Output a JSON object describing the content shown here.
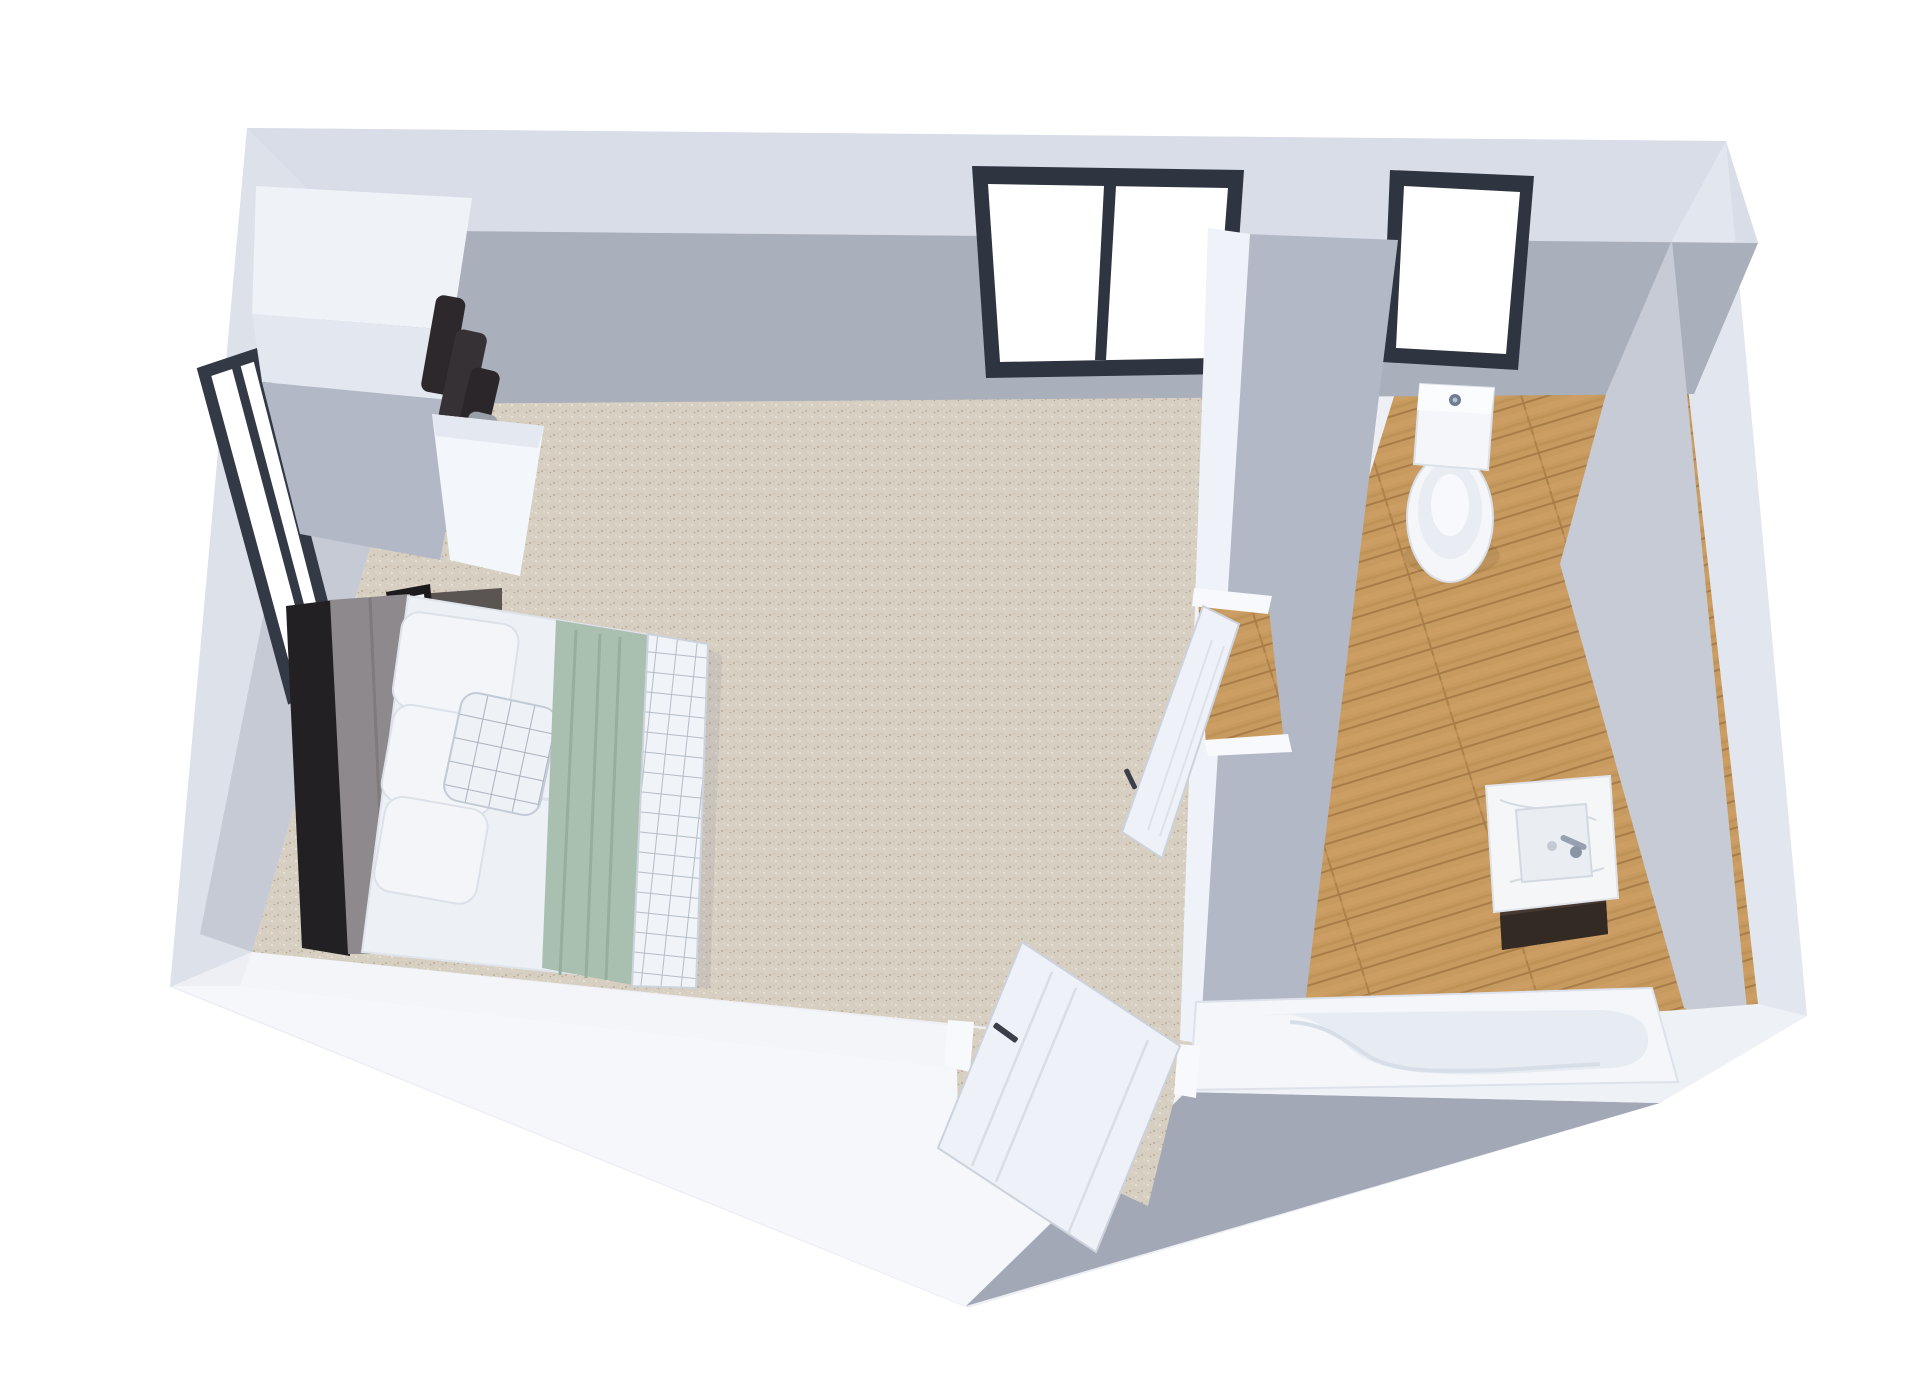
{
  "scene": {
    "title": "3D floor plan render - bedroom with ensuite bathroom",
    "view": "isometric top-down cutaway",
    "rooms": [
      {
        "name": "bedroom",
        "floor": "beige speckled carpet",
        "furniture": [
          "double bed with dark frame and gray upholstered headboard",
          "three white pillows",
          "checkered accent pillow",
          "white duvet",
          "sage green bed runner",
          "checkered throw blanket at foot of bed",
          "dark nightstand",
          "white cylinder table lamp",
          "leaning picture frame",
          "stack of books",
          "closet nook with hanging clothes"
        ],
        "windows": [
          "large two-pane window in top wall",
          "tall dark-framed window in left wall"
        ]
      },
      {
        "name": "bathroom",
        "floor": "light oak plank flooring",
        "fixtures": [
          "toilet with tank against top wall",
          "dark vanity cabinet with white marble top and rectangular basin",
          "chrome faucet",
          "built-in bathtub along bottom wall"
        ],
        "windows": [
          "single-pane dark-framed window in top wall"
        ],
        "doors": [
          "white interior door, open into bedroom"
        ]
      }
    ],
    "doors": [
      "bathroom door (white, open)",
      "entry door in bottom wall (white, open)"
    ]
  },
  "colors": {
    "background": "#ffffff",
    "wall_outer": "#edeff5",
    "wall_top_face": "#d8dde8",
    "wall_outer_left": "#dde1ea",
    "wall_outer_right": "#e2e6ee",
    "wall_inner_top": "#a9afbb",
    "wall_inner_left": "#c5cad5",
    "wall_inner_right": "#c6cbd6",
    "wall_white_face": "#f5f7fb",
    "wall_band_white": "#f3f5f9",
    "wall_shadow_face": "#a2a8b5",
    "partition_white": "#eff2f8",
    "partition_gray": "#b2b8c5",
    "window_frame": "#2e3440",
    "window_glass": "#ffffff",
    "carpet_base": "#d7cfc2",
    "carpet_speck_dark": "#bfb29c",
    "carpet_speck_light": "#ece6da",
    "wood_base": "#c79a5f",
    "wood_gap": "#a87c46",
    "wood_light": "#d2a368",
    "bed_frame_dark": "#232023",
    "headboard_gray": "#8d898d",
    "bedding_white": "#edf0f5",
    "pillow_white": "#f3f5f9",
    "check_line": "#a9b2bf",
    "runner_sage": "#a9bfb0",
    "runner_fold": "#97ae9d",
    "clothes_dark": "#2c282b",
    "clothes_gray": "#9aa0aa",
    "nightstand_dark": "#5a5452",
    "lamp_white": "#e8ecf3",
    "fixture_white": "#f4f6fa",
    "fixture_inner": "#e7ecf3",
    "vanity_cabinet": "#463931",
    "marble": "#f5f6f8",
    "chrome": "#96a0ae",
    "door_leaf": "#eef1f7",
    "door_frame": "#f7f9fc",
    "door_handle": "#3a3f4a"
  }
}
